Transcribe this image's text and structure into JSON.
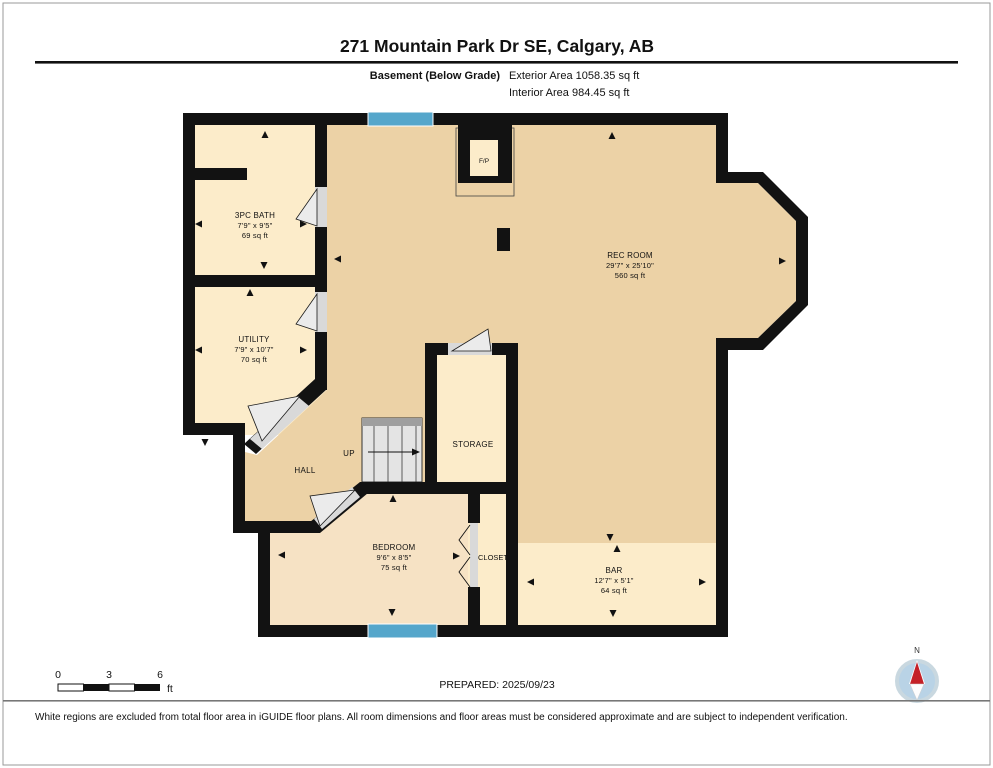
{
  "header": {
    "title": "271 Mountain Park Dr SE, Calgary, AB",
    "floor_label": "Basement (Below Grade)",
    "exterior_area": "Exterior Area 1058.35 sq ft",
    "interior_area": "Interior Area 984.45 sq ft"
  },
  "rooms": [
    {
      "name": "3PC BATH",
      "dims": "7'9\" x 9'5\"",
      "area": "69 sq ft"
    },
    {
      "name": "UTILITY",
      "dims": "7'9\" x 10'7\"",
      "area": "70 sq ft"
    },
    {
      "name": "REC ROOM",
      "dims": "29'7\" x 25'10\"",
      "area": "560 sq ft"
    },
    {
      "name": "BEDROOM",
      "dims": "9'6\" x 8'5\"",
      "area": "75 sq ft"
    },
    {
      "name": "BAR",
      "dims": "12'7\" x 5'1\"",
      "area": "64 sq ft"
    }
  ],
  "labels": {
    "fireplace": "F/P",
    "hall": "HALL",
    "up": "UP",
    "storage": "STORAGE",
    "closet": "CLOSET"
  },
  "scale_bar": {
    "tick0": "0",
    "tick1": "3",
    "tick2": "6",
    "unit": "ft"
  },
  "prepared": "PREPARED: 2025/09/23",
  "compass": {
    "north_label": "N"
  },
  "disclaimer": "White regions are excluded from total floor area in iGUIDE floor plans. All room dimensions and floor areas must be considered approximate and are subject to independent verification.",
  "colors": {
    "walls": "#121212",
    "open_area_fill": "#ecd2a6",
    "room_fill": "#fcecca",
    "bedroom_fill": "#f6e2c4",
    "window_blue": "#55a6cb",
    "stairs_grey": "#e4e4e4",
    "compass_blue": "#b9d3e6",
    "needle_red": "#c42127"
  }
}
